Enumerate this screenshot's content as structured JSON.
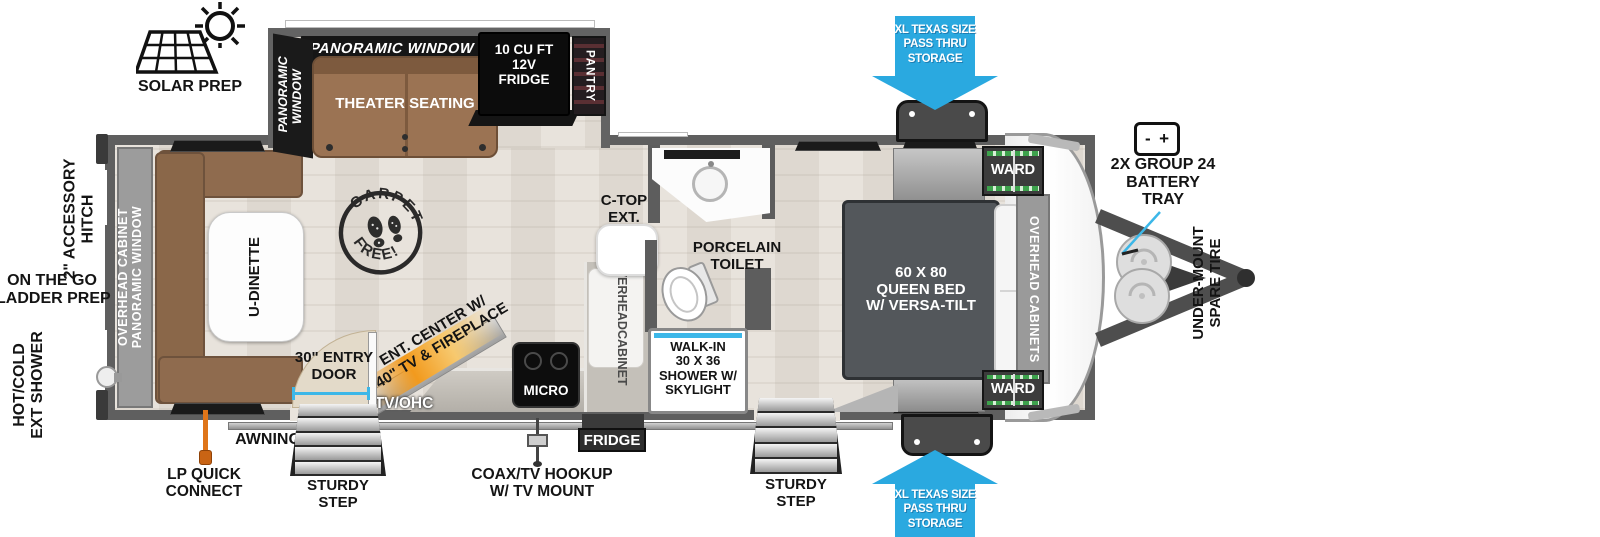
{
  "colors": {
    "arrow-blue": "#2aa9e0",
    "skylight-blue": "#3cb7e8",
    "fireplace-orange": "#f29a1d",
    "lp-orange": "#df7519",
    "ward-green": "#3da24c"
  },
  "exterior": {
    "solar_prep": "SOLAR PREP",
    "accessory_hitch": {
      "line1": "2\" ACCESSORY",
      "line2": "HITCH"
    },
    "ladder_prep": {
      "line1": "ON THE GO",
      "line2": "LADDER PREP"
    },
    "ext_shower": {
      "line1": "HOT/COLD",
      "line2": "EXT SHOWER"
    },
    "lp_quick_connect": {
      "line1": "LP QUICK",
      "line2": "CONNECT"
    },
    "awning": "AWNING",
    "sturdy_step": {
      "line1": "STURDY",
      "line2": "STEP"
    },
    "coax_hookup": {
      "line1": "COAX/TV HOOKUP",
      "line2": "W/ TV MOUNT"
    },
    "battery": {
      "minus": "-",
      "plus": "+",
      "line1": "2X GROUP 24",
      "line2": "BATTERY",
      "line3": "TRAY"
    },
    "spare_tire": {
      "line1": "UNDER-MOUNT",
      "line2": "SPARE TIRE"
    },
    "pass_thru": {
      "line1": "XL TEXAS SIZE",
      "line2": "PASS THRU",
      "line3": "STORAGE"
    }
  },
  "interior": {
    "panoramic_window_top": "PANORAMIC WINDOW",
    "panoramic_window_side": {
      "line1": "PANORAMIC",
      "line2": "WINDOW"
    },
    "theater_seating": "THEATER SEATING",
    "fridge_12v": {
      "line1": "10 CU FT",
      "line2": "12V",
      "line3": "FRIDGE"
    },
    "pantry": "PANTRY",
    "rear_wall": {
      "line1": "OVERHEAD CABINET",
      "line2": "PANORAMIC WINDOW"
    },
    "u_dinette": "U-DINETTE",
    "carpet_free": {
      "top": "CARPET",
      "bottom": "FREE!"
    },
    "entry_door": {
      "line1": "30\" ENTRY",
      "line2": "DOOR"
    },
    "ent_center": {
      "line1": "ENT. CENTER W/",
      "line2": "40\" TV & FIREPLACE"
    },
    "tv_ohc": "TV/OHC",
    "micro": "MICRO",
    "fridge": "FRIDGE",
    "overhead_cabinet": {
      "line1": "OVERHEAD",
      "line2": "CABINET"
    },
    "c_top_ext": {
      "line1": "C-TOP",
      "line2": "EXT."
    },
    "porcelain_toilet": {
      "line1": "PORCELAIN",
      "line2": "TOILET"
    },
    "shower": {
      "line1": "WALK-IN",
      "line2": "30 X 36",
      "line3": "SHOWER W/",
      "line4": "SKYLIGHT"
    },
    "queen_bed": {
      "line1": "60 X 80",
      "line2": "QUEEN BED",
      "line3": "W/ VERSA-TILT"
    },
    "overhead_cabinets_front": "OVERHEAD CABINETS",
    "ward": "WARD"
  }
}
